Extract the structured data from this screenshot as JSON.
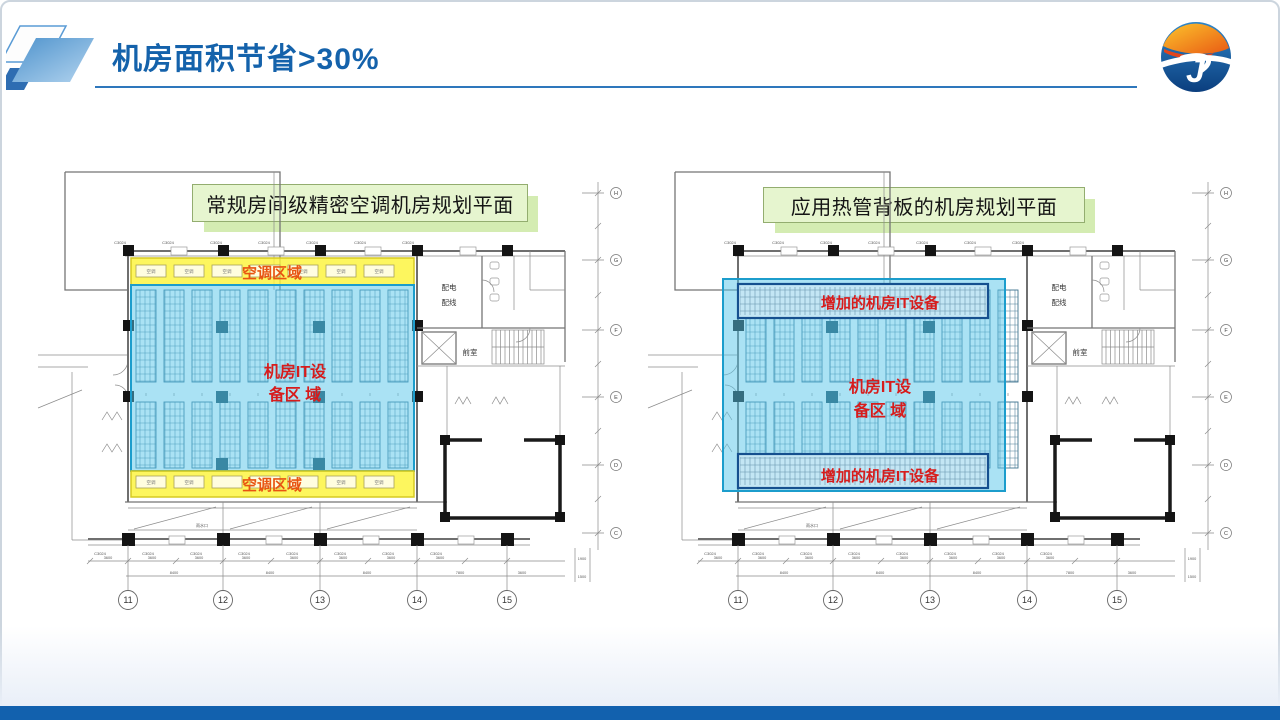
{
  "slide": {
    "title": "机房面积节省>30%"
  },
  "plans": {
    "left": {
      "caption": "常规房间级精密空调机房规划平面",
      "ac_top": "空调区域",
      "ac_bottom": "空调区域",
      "ac_unit": "空调",
      "it_line1": "机房IT设",
      "it_line2": "备区 域"
    },
    "right": {
      "caption": "应用热管背板的机房规划平面",
      "added_top": "增加的机房IT设备",
      "added_bottom": "增加的机房IT设备",
      "it_line1": "机房IT设",
      "it_line2": "备区 域"
    }
  },
  "drawing": {
    "window_label": "C3024",
    "grid_numbers": [
      "11",
      "12",
      "13",
      "14",
      "15"
    ],
    "axis_letters": [
      "H",
      "G",
      "F",
      "E",
      "D",
      "C"
    ],
    "dims_top": [
      "3600",
      "3600",
      "3600",
      "3600",
      "3600",
      "3600",
      "3600",
      "3600"
    ],
    "dims_bottom": [
      "8400",
      "8400",
      "8400",
      "7800",
      "3600"
    ],
    "dims_right": [
      "1900",
      "1500"
    ],
    "rooms": {
      "power_1": "配电",
      "power_2": "配线",
      "lobby": "前室"
    },
    "drain": "雨水口"
  },
  "colors": {
    "title": "#1462ab",
    "footer": "#1261ae",
    "accent_red": "#d71c1c",
    "accent_orange": "#e85412",
    "zone_blue": "#56c5e9",
    "zone_yellow": "#fdf43b",
    "caption_bg": "#e6f5cf"
  }
}
